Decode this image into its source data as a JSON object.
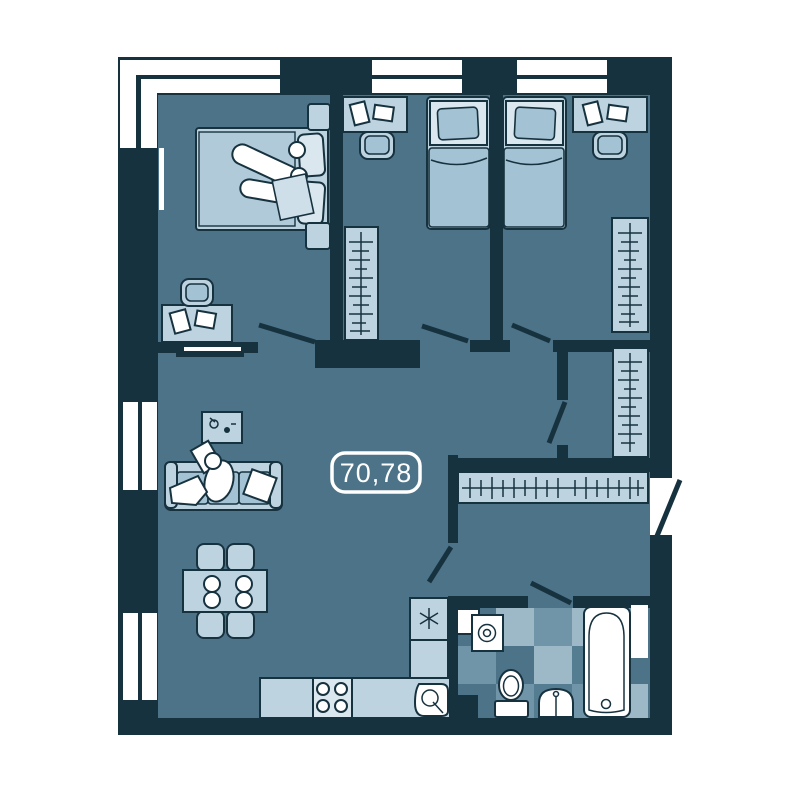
{
  "area_label": "70,78",
  "colors": {
    "wall": "#17323f",
    "floor": "#4d7389",
    "furniture_light": "#bdd3e0",
    "furniture_lighter": "#dbe7ee",
    "furniture_mid": "#a3c2d3",
    "white": "#ffffff",
    "tile_light": "#9db9c8",
    "tile_mid": "#7195a8",
    "tile_dark": "#557d91"
  },
  "furniture_icons": [
    "double-bed",
    "single-bed",
    "desk",
    "desk-chair",
    "wardrobe-rack",
    "mirror",
    "tv",
    "sofa",
    "coffee-table",
    "dining-table",
    "dining-chair",
    "fridge",
    "snowflake-icon",
    "kitchen-counter",
    "stove",
    "kitchen-sink",
    "washing-machine",
    "toilet",
    "bathroom-sink",
    "bathtub",
    "coat-rack",
    "door-swing"
  ]
}
